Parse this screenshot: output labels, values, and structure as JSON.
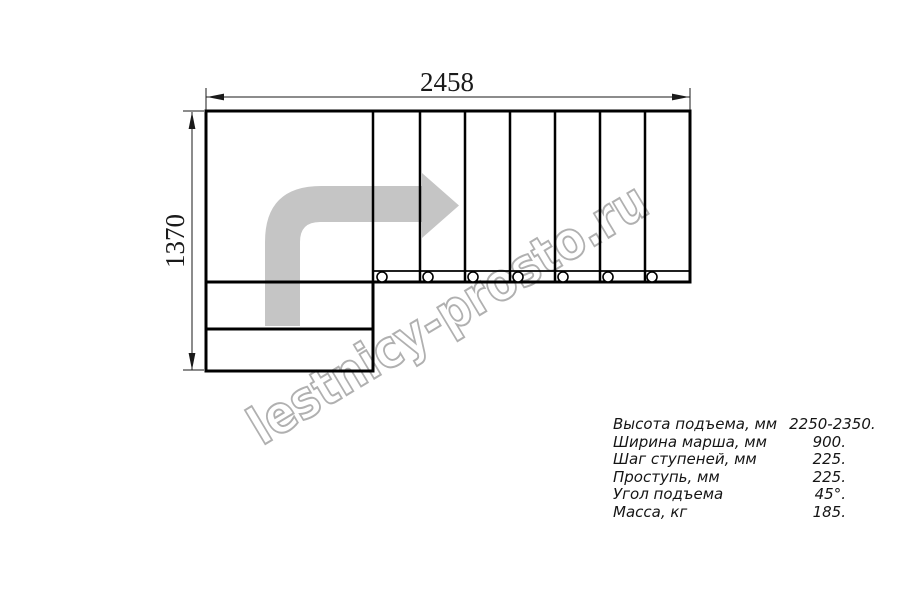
{
  "drawing": {
    "dim_width": "2458",
    "dim_height": "1370",
    "watermark": "lestnicy-prosto.ru",
    "tread_count": 7,
    "colors": {
      "line": "#000000",
      "arrow_fill": "#c5c5c5",
      "watermark_stroke": "#b0b0b0"
    }
  },
  "specs": {
    "rows": [
      {
        "label": "Высота подъема, мм",
        "value": "2250-2350."
      },
      {
        "label": "Ширина марша, мм",
        "value": "900."
      },
      {
        "label": "Шаг ступеней, мм",
        "value": "225."
      },
      {
        "label": "Проступь, мм",
        "value": "225."
      },
      {
        "label": "Угол подъема",
        "value": "45°."
      },
      {
        "label": "Масса, кг",
        "value": "185."
      }
    ]
  }
}
